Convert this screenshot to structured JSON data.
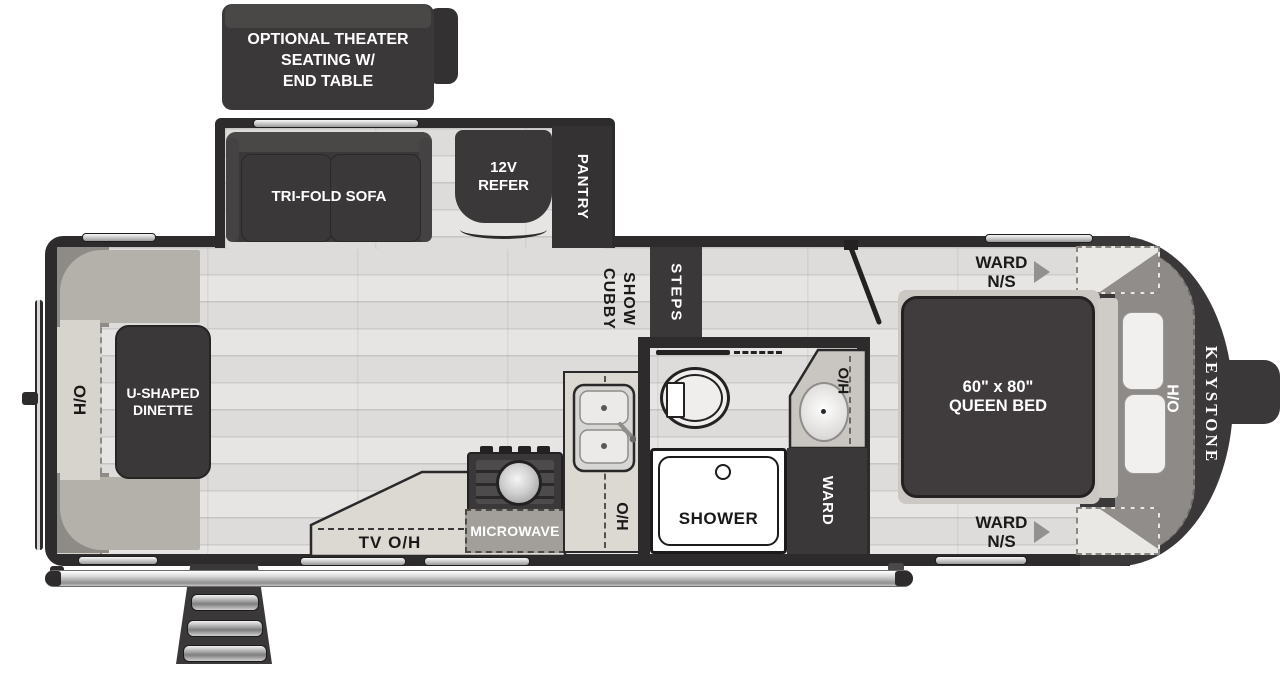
{
  "exterior": {
    "theater_seating": "OPTIONAL THEATER\nSEATING W/\nEND TABLE",
    "brand": "KEYSTONE"
  },
  "slide_out": {
    "sofa": "TRI-FOLD SOFA",
    "refrigerator": "12V\nREFER",
    "pantry": "PANTRY"
  },
  "living": {
    "dinette": "U-SHAPED\nDINETTE",
    "overhead_rear": "O/H",
    "show_cubby": "SHOW\nCUBBY",
    "steps": "STEPS",
    "tv_overhead": "TV  O/H"
  },
  "kitchen": {
    "microwave": "MICROWAVE",
    "overhead": "O/H",
    "hutch_overhead": "H/O"
  },
  "bathroom": {
    "shower": "SHOWER",
    "wardrobe": "WARD",
    "hutch_overhead": "H/O"
  },
  "bedroom": {
    "ward_ns_top": "WARD\nN/S",
    "ward_ns_bottom": "WARD\nN/S",
    "bed": "60\" x 80\"\nQUEEN BED",
    "hutch_overhead": "H/O"
  },
  "colors": {
    "furniture_dark": "#3b3839",
    "wall_dark": "#2e2b2c",
    "floor_light": "#e5e4e2",
    "counter": "#dcd9d3",
    "bench_gray": "#b4b1aa",
    "headboard_gray": "#8e8a87",
    "label_dark": "#1b1918",
    "label_light": "#ffffff"
  }
}
